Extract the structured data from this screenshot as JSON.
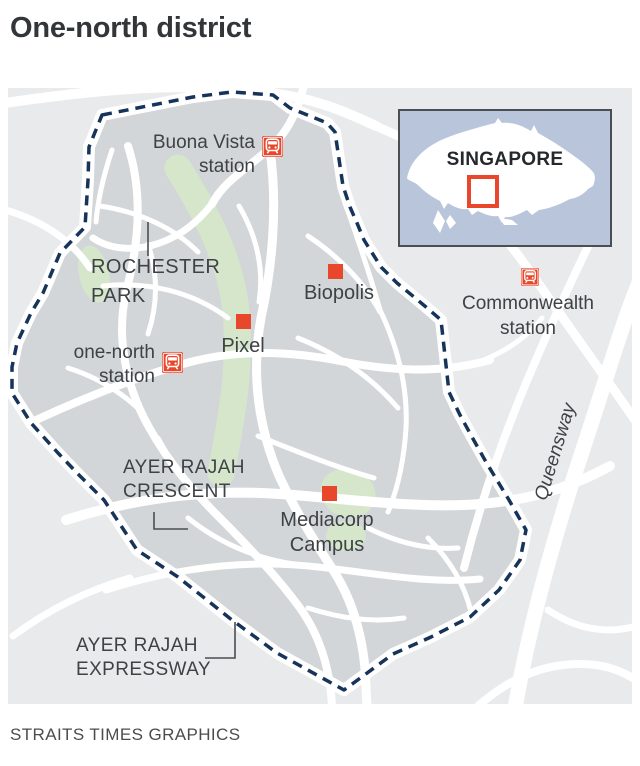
{
  "title": "One-north district",
  "credit": "STRAITS TIMES GRAPHICS",
  "colors": {
    "accent_red": "#E8472B",
    "boundary_navy": "#16335A",
    "district_fill": "#D2D6D9",
    "map_background": "#E8EAEC",
    "park_green": "#D5E6CB",
    "road_white": "#FFFFFF",
    "inset_background": "#B9C5DA",
    "label_text": "#3E4245"
  },
  "inset": {
    "country_label": "SINGAPORE"
  },
  "labels": {
    "buona_vista": {
      "line1": "Buona Vista",
      "line2": "station"
    },
    "rochester_park": {
      "line1": "ROCHESTER",
      "line2": "PARK"
    },
    "biopolis": {
      "text": "Biopolis"
    },
    "pixel": {
      "text": "Pixel"
    },
    "one_north": {
      "line1": "one-north",
      "line2": "station"
    },
    "commonwealth": {
      "line1": "Commonwealth",
      "line2": "station"
    },
    "queensway": {
      "text": "Queensway"
    },
    "ayer_rajah_crescent": {
      "line1": "AYER RAJAH",
      "line2": "CRESCENT"
    },
    "mediacorp": {
      "line1": "Mediacorp",
      "line2": "Campus"
    },
    "ayer_rajah_expressway": {
      "line1": "AYER RAJAH",
      "line2": "EXPRESSWAY"
    }
  }
}
